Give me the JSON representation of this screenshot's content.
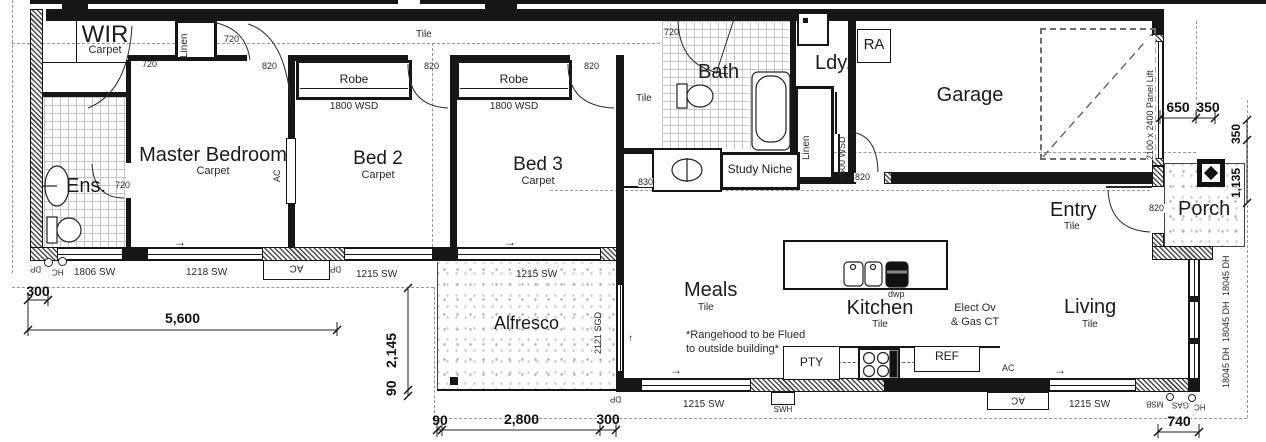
{
  "rooms": {
    "wir": {
      "name": "WIR",
      "finish": "Carpet",
      "door": "720"
    },
    "ens": {
      "name": "Ens.",
      "door": "720"
    },
    "master": {
      "name": "Master Bedroom",
      "finish": "Carpet",
      "door": "820"
    },
    "bed2": {
      "name": "Bed 2",
      "finish": "Carpet",
      "door": "820"
    },
    "bed3": {
      "name": "Bed 3",
      "finish": "Carpet",
      "door": "820"
    },
    "bath": {
      "name": "Bath",
      "finish": "Tile",
      "door": "720"
    },
    "laundry": {
      "name": "Ldy.",
      "door": "820"
    },
    "garage": {
      "name": "Garage",
      "door": "2100 x 2400 Panel Lift"
    },
    "entry": {
      "name": "Entry",
      "finish": "Tile",
      "door": "820"
    },
    "porch": {
      "name": "Porch"
    },
    "living": {
      "name": "Living",
      "finish": "Tile"
    },
    "kitchen": {
      "name": "Kitchen",
      "finish": "Tile"
    },
    "meals": {
      "name": "Meals",
      "finish": "Tile"
    },
    "alfresco": {
      "name": "Alfresco",
      "door": "2121 SGD"
    },
    "hall": {
      "finish": "Tile",
      "opening": "830"
    },
    "study": {
      "name": "Study Niche"
    }
  },
  "storage": {
    "robe": {
      "name": "Robe",
      "door": "1800 WSD"
    },
    "linen_hall": {
      "name": "Linen",
      "door": "720"
    },
    "linen_ldy": {
      "name": "Linen",
      "door": "1500 WSD"
    }
  },
  "windows": {
    "w1806": "1806 SW",
    "w1218": "1218 SW",
    "w1215": "1215 SW",
    "w18045": "18045 DH"
  },
  "kitchen_items": {
    "pty": "PTY",
    "ref": "REF",
    "dwp": "dwp",
    "cook1": "Elect  Ov",
    "cook2": "& Gas CT"
  },
  "note": {
    "line1": "*Rangehood to be Flued",
    "line2": "to outside building*"
  },
  "services": {
    "ac": "AC",
    "dp": "DP",
    "hc": "HC",
    "msb": "MSB",
    "gas": "GAS",
    "swh": "SWH",
    "ra": "RA"
  },
  "dims": {
    "n300": "300",
    "n5600": "5,600",
    "n2145": "2,145",
    "n90": "90",
    "n2800": "2,800",
    "n740": "740",
    "n650": "650",
    "n350": "350",
    "n1135": "1,135"
  },
  "symbols": {
    "arrow_right": "→",
    "arrow_up": "↑"
  }
}
